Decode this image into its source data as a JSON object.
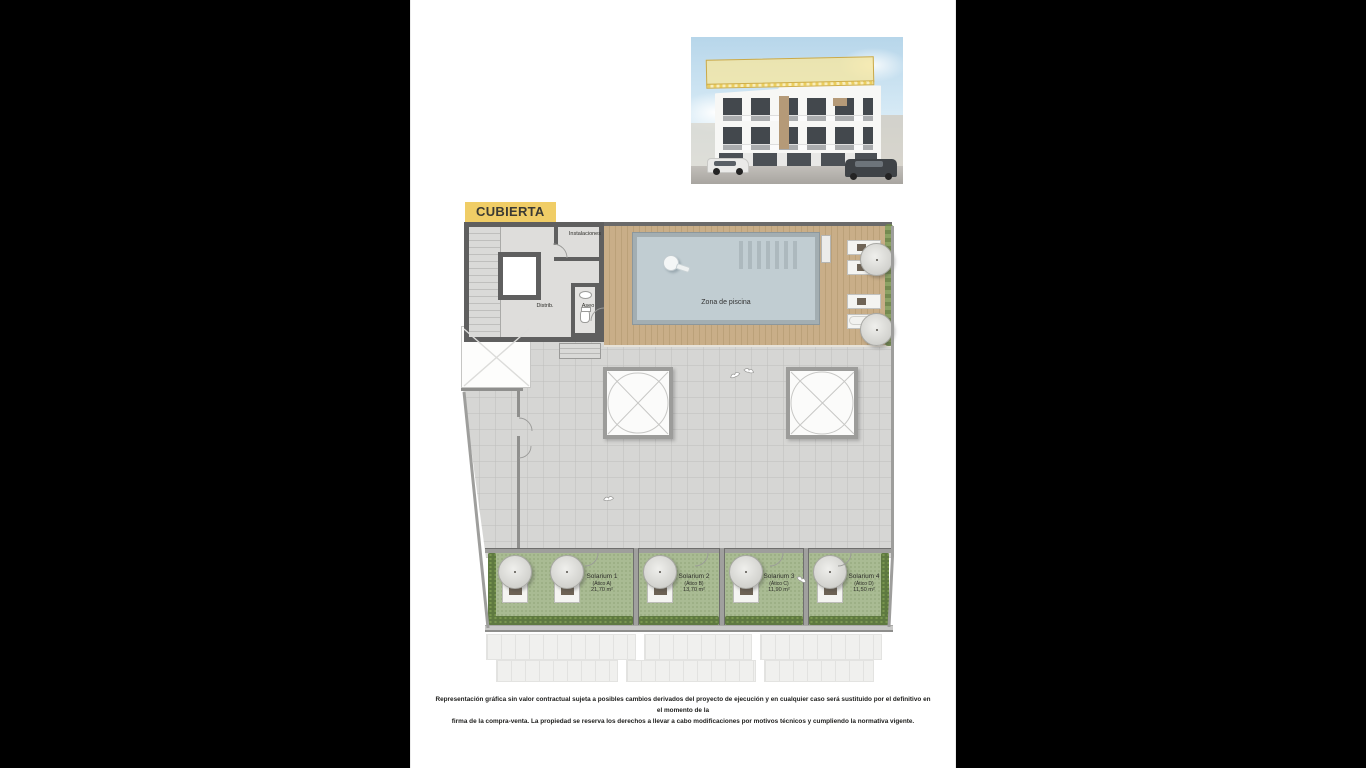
{
  "page": {
    "title": "CUBIERTA"
  },
  "plan": {
    "labels": {
      "instalaciones": "Instalaciones",
      "distribuidor": "Distrib.",
      "aseo": "Aseo",
      "zona_piscina": "Zona de piscina"
    },
    "solariums": [
      {
        "name": "Solarium 1",
        "unit": "(Ático A)",
        "area": "21,70 m²"
      },
      {
        "name": "Solarium 2",
        "unit": "(Ático B)",
        "area": "13,70 m²"
      },
      {
        "name": "Solarium 3",
        "unit": "(Ático C)",
        "area": "11,90 m²"
      },
      {
        "name": "Solarium 4",
        "unit": "(Ático D)",
        "area": "11,50 m²"
      }
    ]
  },
  "disclaimer": {
    "line1": "Representación gráfica sin valor contractual sujeta a posibles cambios derivados del proyecto de ejecución y en cualquier caso será sustituido por el definitivo en el momento de la",
    "line2": "firma de la compra-venta. La propiedad se reserva los derechos a llevar a cabo modificaciones por motivos técnicos y cumpliendo la normativa vigente."
  },
  "colors": {
    "highlight_yellow": "#f0cd66",
    "wall_dark": "#5f5f5f",
    "wood_deck": "#c9ae88",
    "pool_water": "#c1cdd2",
    "concrete": "#d6d6d4",
    "turf_green": "#a9bb93",
    "hedge_green": "#5e7940"
  }
}
